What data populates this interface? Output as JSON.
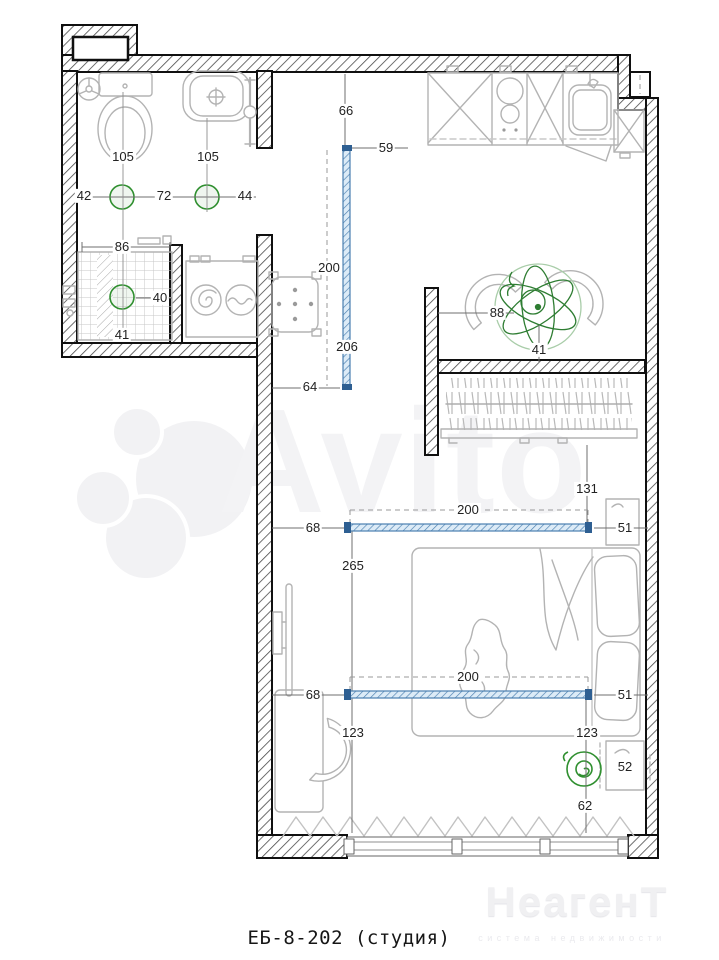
{
  "plan": {
    "caption": "ЕБ-8-202 (студия)",
    "dims": [
      {
        "t": "105"
      },
      {
        "t": "105"
      },
      {
        "t": "42"
      },
      {
        "t": "72"
      },
      {
        "t": "44"
      },
      {
        "t": "86"
      },
      {
        "t": "40"
      },
      {
        "t": "41"
      },
      {
        "t": "66"
      },
      {
        "t": "59"
      },
      {
        "t": "200"
      },
      {
        "t": "206"
      },
      {
        "t": "64"
      },
      {
        "t": "88"
      },
      {
        "t": "41"
      },
      {
        "t": "131"
      },
      {
        "t": "200"
      },
      {
        "t": "68"
      },
      {
        "t": "51"
      },
      {
        "t": "265"
      },
      {
        "t": "200"
      },
      {
        "t": "68"
      },
      {
        "t": "51"
      },
      {
        "t": "123"
      },
      {
        "t": "123"
      },
      {
        "t": "52"
      },
      {
        "t": "62"
      }
    ]
  },
  "watermark": {
    "brand": "Avito"
  },
  "logo": {
    "brand": "НеагенТ",
    "tagline": "система недвижимости"
  },
  "colors": {
    "wall": "#101010",
    "furniture": "#b3b3b3",
    "dimension_text": "#222222",
    "partition_blue": "#4a7fb0",
    "fixture_green": "#2f8f2f",
    "watermark_gray": "#f3f3f5"
  }
}
